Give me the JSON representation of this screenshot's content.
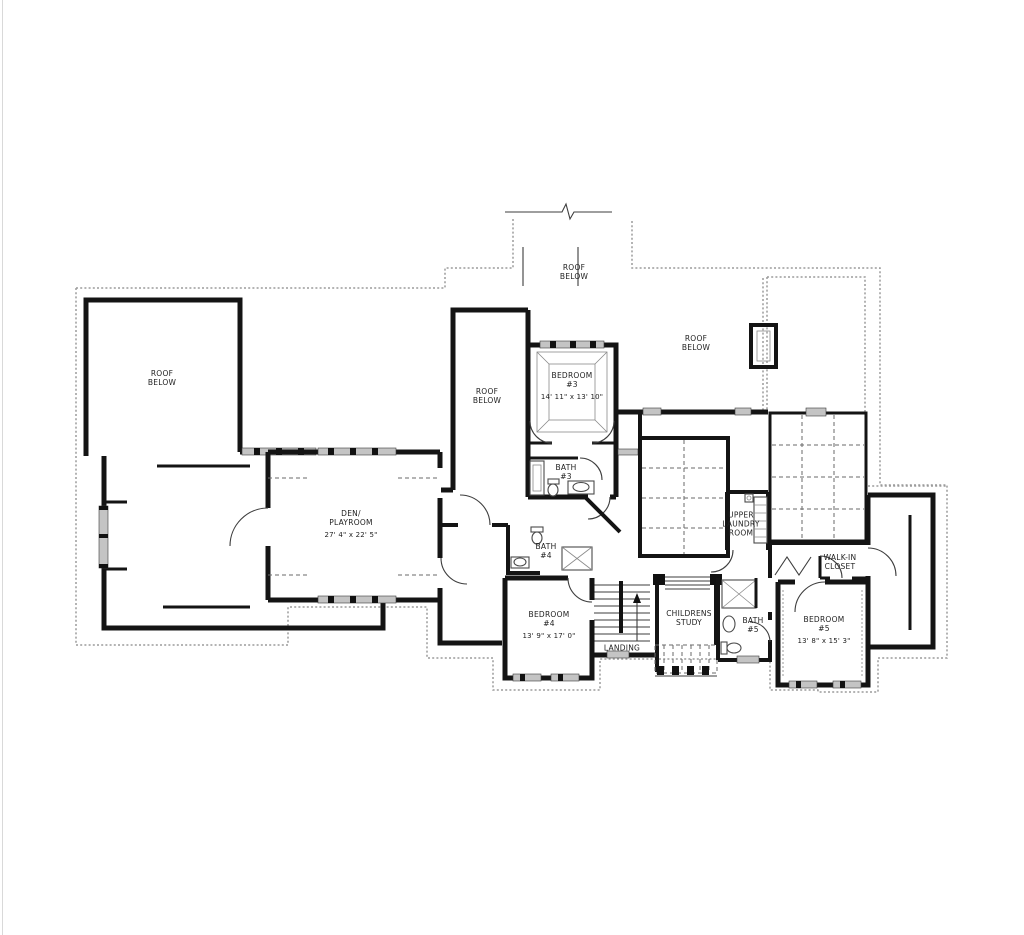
{
  "document": {
    "type": "architectural second-floor plan drawing"
  },
  "colors": {
    "wall": "#141414",
    "overhang_dotted": "#9b9b9b",
    "window_fill": "#c4c4c4",
    "text": "#222222",
    "background": "#ffffff"
  },
  "labels": {
    "roof_below_left": {
      "lines": [
        "ROOF",
        "BELOW"
      ]
    },
    "roof_below_top": {
      "lines": [
        "ROOF",
        "BELOW"
      ]
    },
    "roof_below_right": {
      "lines": [
        "ROOF",
        "BELOW"
      ]
    },
    "roof_below_center": {
      "lines": [
        "ROOF",
        "BELOW"
      ]
    },
    "bedroom3": {
      "name_lines": [
        "BEDROOM",
        "#3"
      ],
      "dims": "14' 11\" x 13' 10\""
    },
    "bath3": {
      "lines": [
        "BATH",
        "#3"
      ]
    },
    "den": {
      "name_lines": [
        "DEN/",
        "PLAYROOM"
      ],
      "dims": "27' 4\" x 22' 5\""
    },
    "bath4": {
      "lines": [
        "BATH",
        "#4"
      ]
    },
    "upper_laundry": {
      "lines": [
        "UPPER",
        "LAUNDRY",
        "ROOM"
      ]
    },
    "walk_in_closet": {
      "lines": [
        "WALK-IN",
        "CLOSET"
      ]
    },
    "bedroom4": {
      "name_lines": [
        "BEDROOM",
        "#4"
      ],
      "dims": "13' 9\" x 17' 0\""
    },
    "landing": {
      "lines": [
        "LANDING"
      ]
    },
    "childrens_study": {
      "lines": [
        "CHILDRENS",
        "STUDY"
      ]
    },
    "bath5": {
      "lines": [
        "BATH",
        "#5"
      ]
    },
    "bedroom5": {
      "name_lines": [
        "BEDROOM",
        "#5"
      ],
      "dims": "13' 8\" x 15' 3\""
    }
  }
}
